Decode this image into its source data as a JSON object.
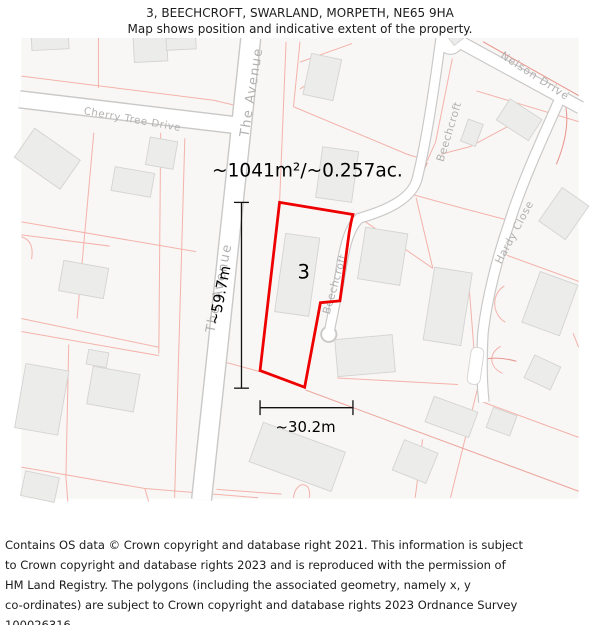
{
  "title": {
    "line1": "3, BEECHCROFT, SWARLAND, MORPETH, NE65 9HA",
    "line2": "Map shows position and indicative extent of the property."
  },
  "map": {
    "area_label": "~1041m²/~0.257ac.",
    "plot_number": "3",
    "height_label": "~59.7m",
    "width_label": "~30.2m",
    "roads": {
      "the_avenue": "The Avenue",
      "cherry_tree_drive": "Cherry Tree Drive",
      "beechcroft": "Beechcroft",
      "nelson_drive": "Nelson Drive",
      "hardy_close": "Hardy Close"
    },
    "colors": {
      "property_outline": "#ee0000",
      "parcel_line": "#f4b3ab",
      "parcel_line_strong": "#e9958c",
      "road_casing": "#c9c8c7",
      "road_fill": "#ffffff",
      "building_fill": "#ececeb",
      "building_stroke": "#d5d4d3",
      "road_label": "#b3b1b0",
      "map_background": "#f8f7f6",
      "measurement": "#111111"
    }
  },
  "footer": {
    "lines": [
      "Contains OS data © Crown copyright and database right 2021. This information is subject",
      "to Crown copyright and database rights 2023 and is reproduced with the permission of",
      "HM Land Registry. The polygons (including the associated geometry, namely x, y",
      "co-ordinates) are subject to Crown copyright and database rights 2023 Ordnance Survey",
      "100026316."
    ]
  }
}
